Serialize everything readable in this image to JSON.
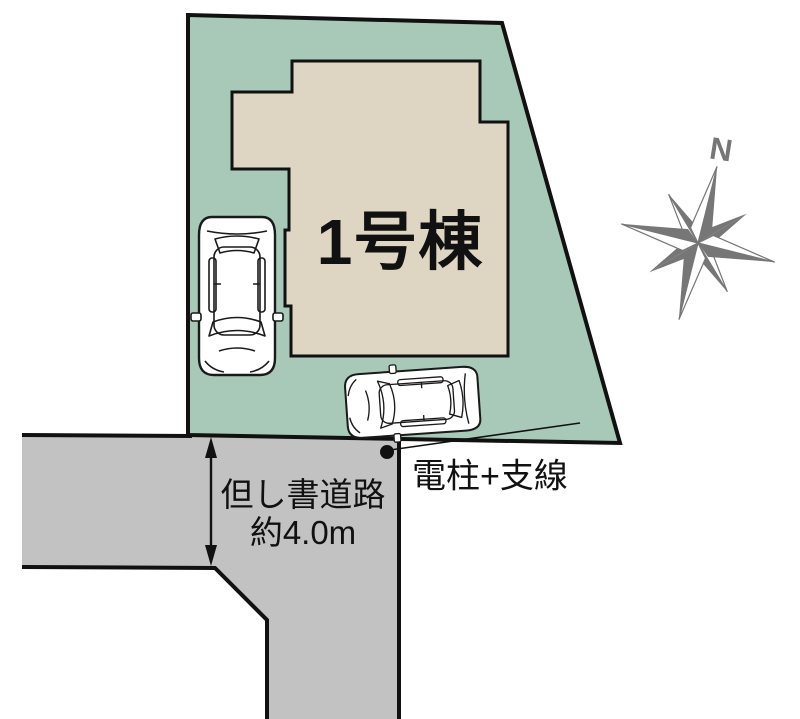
{
  "diagram": {
    "building_label": "1号棟",
    "road_note_line1": "但し書道路",
    "road_note_line2": "約4.0m",
    "pole_label": "電柱+支線",
    "north_label": "N"
  },
  "colors": {
    "background": "#ffffff",
    "plot_fill": "#a8c9b7",
    "building_fill": "#ded5c3",
    "road_fill": "#c2c2c2",
    "outline": "#111111",
    "compass_dark": "#767676",
    "text": "#111111"
  }
}
